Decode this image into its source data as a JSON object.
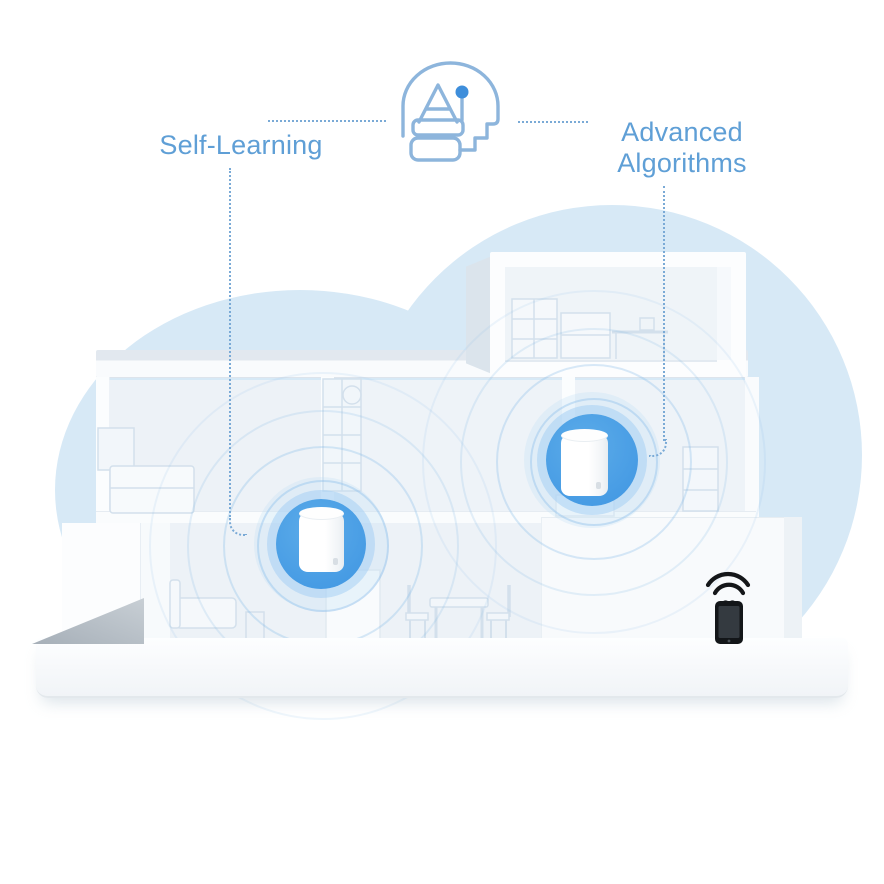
{
  "annotations": {
    "left_label": "Self-Learning",
    "right_label": "Advanced Algorithms",
    "text_color": "#5f9fd6",
    "dotted_line_color": "#7aaad6",
    "ai_icon": "ai-head-icon",
    "ai_icon_stroke": "#8db5dc",
    "ai_icon_dot": "#3e8edb"
  },
  "scene": {
    "type": "isometric house cutaway with mesh wifi units",
    "cloud_color": "#d7e9f6",
    "mesh_unit_accent": "#4aa0e6",
    "units": [
      {
        "name": "mesh-unit-ground-floor"
      },
      {
        "name": "mesh-unit-upper-floor"
      }
    ],
    "phone": {
      "icon": "smartphone-wifi-icon",
      "color": "#141619"
    }
  }
}
